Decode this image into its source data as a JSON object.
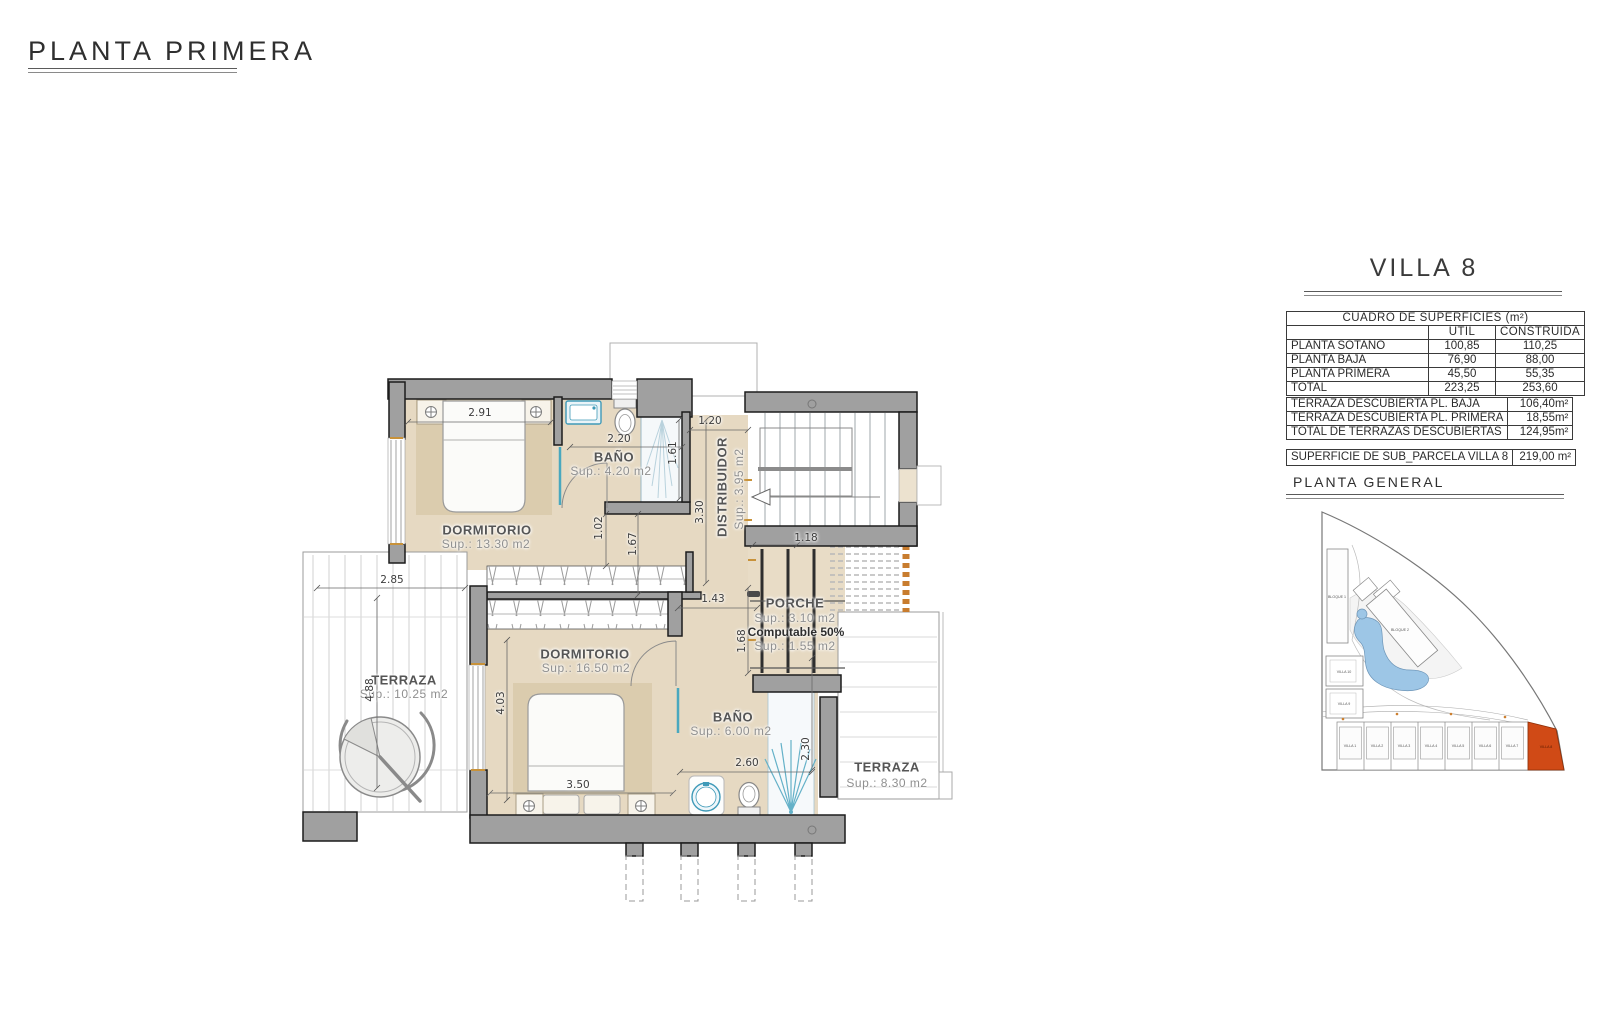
{
  "header": {
    "title": "PLANTA PRIMERA"
  },
  "villa": {
    "title": "VILLA 8"
  },
  "surfaces": {
    "title": "CUADRO DE SUPERFICIES (m²)",
    "col_util": "UTIL",
    "col_construida": "CONSTRUIDA",
    "rows": [
      {
        "label": "PLANTA SOTANO",
        "util": "100,85",
        "construida": "110,25"
      },
      {
        "label": "PLANTA BAJA",
        "util": "76,90",
        "construida": "88,00"
      },
      {
        "label": "PLANTA PRIMERA",
        "util": "45,50",
        "construida": "55,35"
      },
      {
        "label": "TOTAL",
        "util": "223,25",
        "construida": "253,60"
      }
    ]
  },
  "terraces": {
    "rows": [
      {
        "label": "TERRAZA DESCUBIERTA PL. BAJA",
        "value": "106,40m²"
      },
      {
        "label": "TERRAZA DESCUBIERTA PL. PRIMERA",
        "value": "18,55m²"
      },
      {
        "label": "TOTAL DE TERRAZAS DESCUBIERTAS",
        "value": "124,95m²"
      }
    ]
  },
  "parcel": {
    "label": "SUPERFICIE DE SUB_PARCELA VILLA 8",
    "value": "219,00 m²"
  },
  "site": {
    "title": "PLANTA  GENERAL",
    "bloque1": "BLOQUE 1",
    "bloque2": "BLOQUE 2",
    "villa10": "VILLA 10",
    "villa9": "VILLA 9",
    "villas": [
      "VILLA 1",
      "VILLA 2",
      "VILLA 3",
      "VILLA 4",
      "VILLA 5",
      "VILLA 6",
      "VILLA 7",
      "VILLA 8"
    ]
  },
  "plan": {
    "rooms": {
      "dorm1": {
        "name": "DORMITORIO",
        "sup": "Sup.: 13.30  m2"
      },
      "bano1": {
        "name": "BAÑO",
        "sup": "Sup.: 4.20   m2"
      },
      "distribuidor": {
        "name": "DISTRIBUIDOR",
        "sup": "Sup.: 3.95  m2"
      },
      "dorm2": {
        "name": "DORMITORIO",
        "sup": "Sup.: 16.50  m2"
      },
      "bano2": {
        "name": "BAÑO",
        "sup": "Sup.: 6.00   m2"
      },
      "porche": {
        "name": "PORCHE",
        "sup": "Sup.: 3.10   m2",
        "computable": "Computable 50%",
        "sup2": "Sup.: 1.55   m2"
      },
      "terraza1": {
        "name": "TERRAZA",
        "sup": "Sup.: 10.25  m2"
      },
      "terraza2": {
        "name": "TERRAZA",
        "sup": "Sup.: 8.30   m2"
      }
    },
    "dims": {
      "d291": "2.91",
      "d220": "2.20",
      "d161": "1.61",
      "d120": "1.20",
      "d330": "3.30",
      "d102": "1.02",
      "d167": "1.67",
      "d143": "1.43",
      "d118": "1.18",
      "d168": "1.68",
      "d285": "2.85",
      "d488": "4.88",
      "d403": "4.03",
      "d350": "3.50",
      "d260": "2.60",
      "d230": "2.30"
    }
  }
}
